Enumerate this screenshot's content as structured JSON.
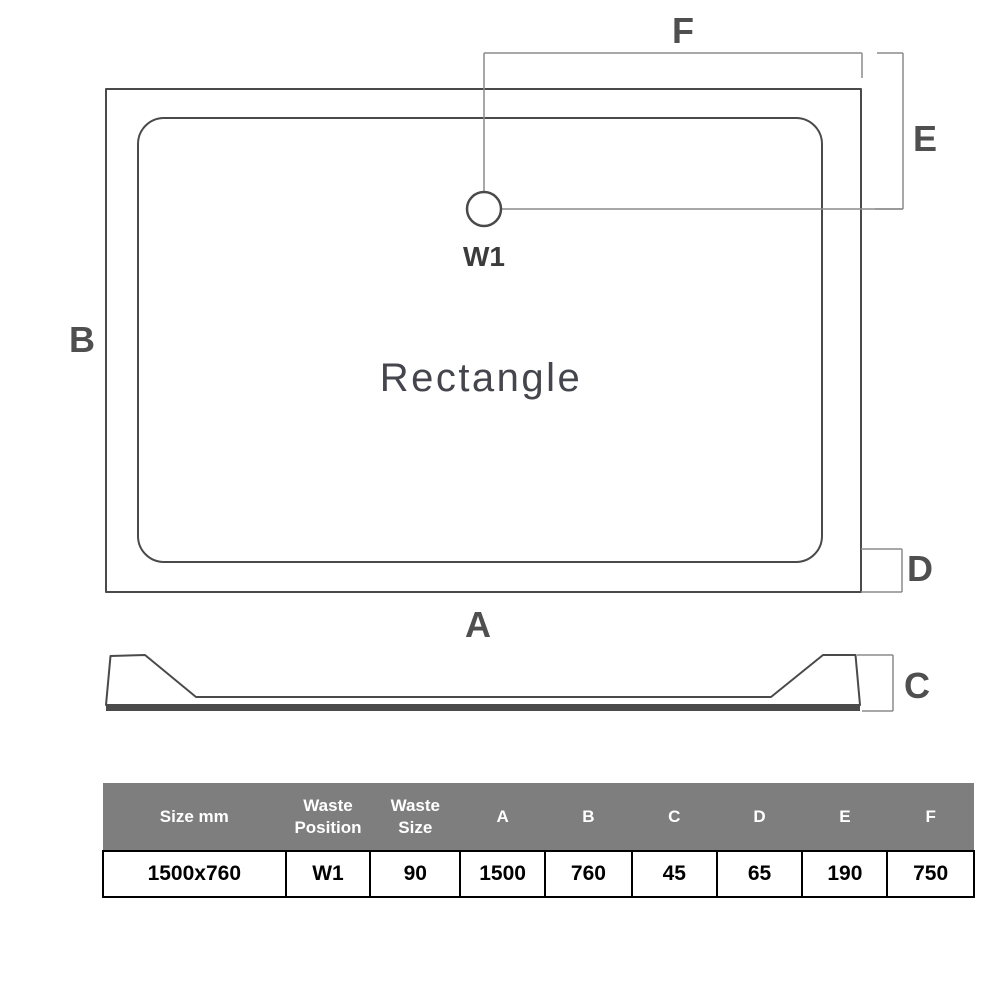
{
  "diagram": {
    "shape_label": "Rectangle",
    "waste_label": "W1",
    "dim_labels": {
      "a": "A",
      "b": "B",
      "c": "C",
      "d": "D",
      "e": "E",
      "f": "F"
    }
  },
  "table": {
    "headers": [
      "Size mm",
      "Waste Position",
      "Waste Size",
      "A",
      "B",
      "C",
      "D",
      "E",
      "F"
    ],
    "row": [
      "1500x760",
      "W1",
      "90",
      "1500",
      "760",
      "45",
      "65",
      "190",
      "750"
    ]
  },
  "colors": {
    "line": "#4a4a4a",
    "dimension_line": "#8c8c8c",
    "label_text": "#4f4f4f",
    "table_header_bg": "#7e7e7e",
    "table_header_text": "#ffffff",
    "table_row_text": "#000000"
  }
}
